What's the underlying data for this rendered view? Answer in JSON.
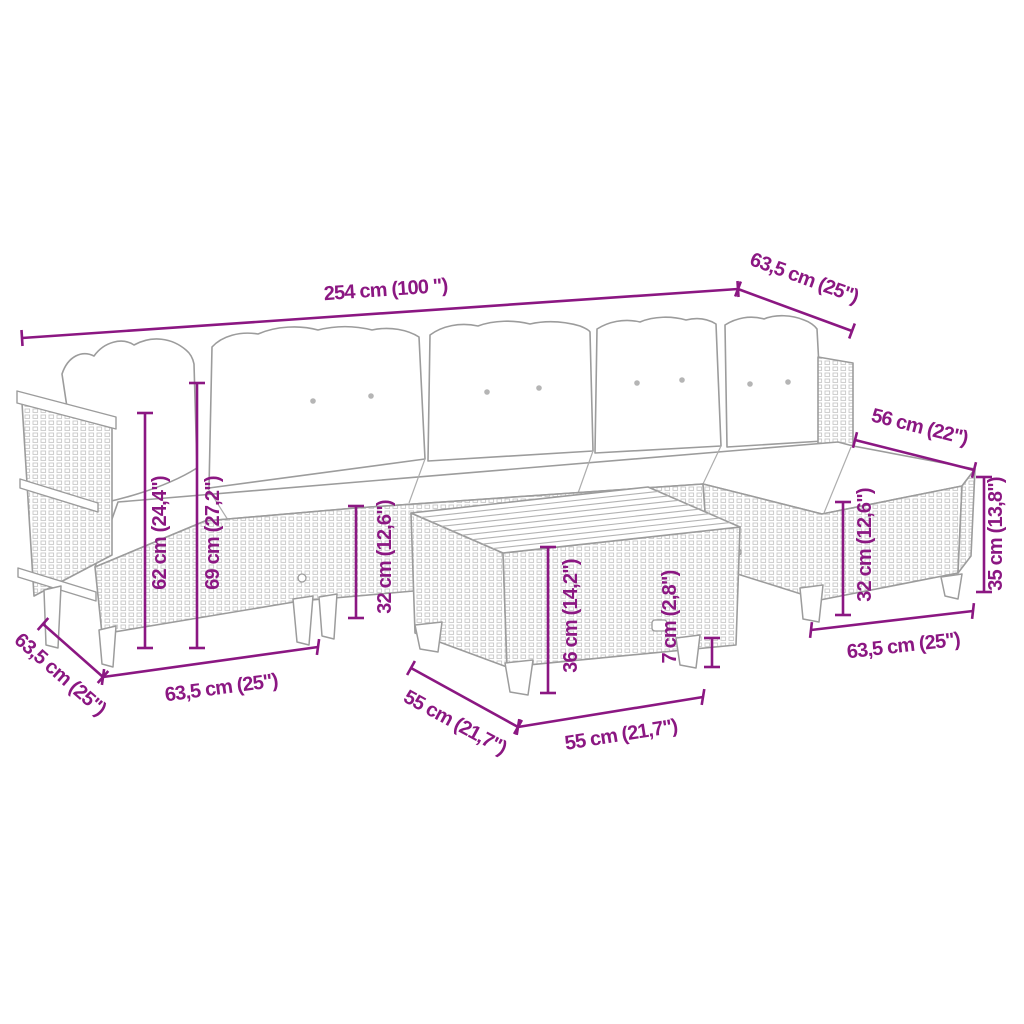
{
  "diagram": {
    "type": "product-dimension-diagram",
    "subject": "garden lounge set with corner sofa, footstool and coffee table"
  },
  "colors": {
    "dimension": "#8B1782",
    "outline": "#9c9c9c",
    "texture": "#c8c8c8",
    "background": "#ffffff"
  },
  "dimensions": {
    "sofa_length": {
      "label": "254 cm (100 \")"
    },
    "sofa_depth": {
      "label": "63,5 cm (25\")"
    },
    "stool_top_depth": {
      "label": "56 cm (22\")"
    },
    "stool_total_height": {
      "label": "35 cm (13,8\")"
    },
    "armrest_height": {
      "label": "62 cm (24,4\")"
    },
    "total_height": {
      "label": "69 cm (27,2\")"
    },
    "seat_height": {
      "label": "32 cm (12,6\")"
    },
    "table_height": {
      "label": "36 cm (14,2\")"
    },
    "table_top_thickness": {
      "label": "7 cm (2,8\")"
    },
    "table_depth": {
      "label": "55 cm (21,7\")"
    },
    "table_width": {
      "label": "55 cm (21,7\")"
    },
    "stool_seat_height": {
      "label": "32 cm (12,6\")"
    },
    "stool_width": {
      "label": "63,5 cm (25\")"
    },
    "corner_module_depth": {
      "label": "63,5 cm (25\")"
    },
    "corner_module_width": {
      "label": "63,5 cm (25\")"
    }
  }
}
